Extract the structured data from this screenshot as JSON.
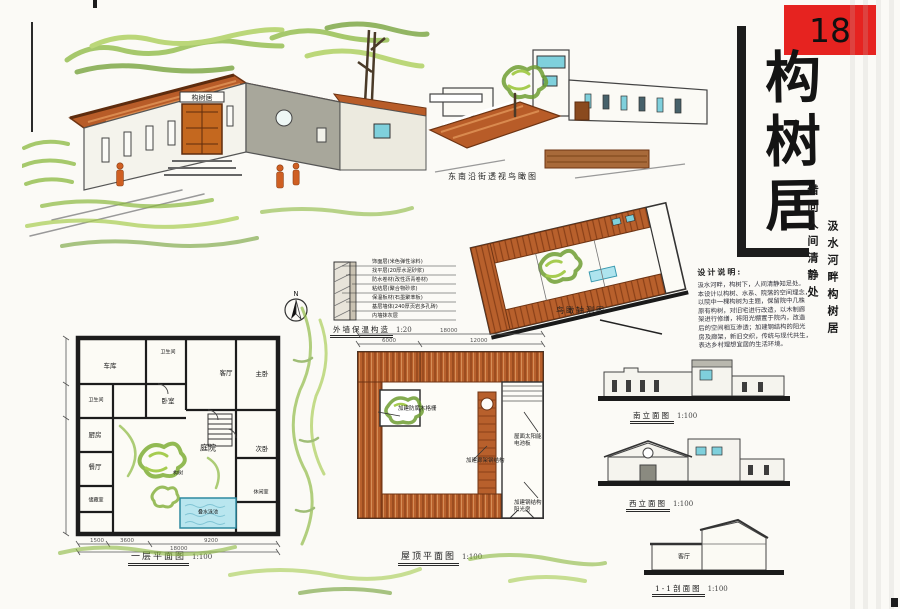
{
  "sheet": {
    "number": "18"
  },
  "title": {
    "main": "构树居",
    "chars": [
      "构",
      "树",
      "居"
    ],
    "subtitle_right_inner": "借问人间清静处",
    "subtitle_right_outer": "汲水河畔构树居"
  },
  "design_notes": {
    "heading": "设计说明:",
    "lines": [
      "汲水河畔，构树下，人间清静知足处。",
      "本设计以构树、水系、院落的空间理念，",
      "以院中一棵构树为主题，保留院中几株",
      "原有构树，对旧宅进行改造，以木制廊",
      "架进行修缮，将阳光棚置于院内，改造",
      "后的空间相互渗透；加建钢结构的阳光",
      "房及廊架，新旧交织，传统与现代共生，",
      "表达乡村理想宜居的生活环境。"
    ]
  },
  "perspectives": {
    "street_caption": "东南沿街透视鸟瞰图",
    "birdseye_caption": "鸟瞰轴测图",
    "door_plaque": "构树居"
  },
  "floor_plan": {
    "caption": "一层平面图",
    "scale": "1:100",
    "north": "N",
    "rooms": [
      {
        "label": "车库"
      },
      {
        "label": "卫生间"
      },
      {
        "label": "客厅"
      },
      {
        "label": "主卧"
      },
      {
        "label": "卧室"
      },
      {
        "label": "卫生间"
      },
      {
        "label": "厨房"
      },
      {
        "label": "餐厅"
      },
      {
        "label": "储藏室"
      },
      {
        "label": "庭院"
      },
      {
        "label": "构树"
      },
      {
        "label": "叠水泳池"
      },
      {
        "label": "次卧"
      },
      {
        "label": "休闲室"
      }
    ],
    "dims": {
      "segments": [
        "1500",
        "3600",
        "9200"
      ],
      "total": "18000"
    }
  },
  "roof_plan": {
    "caption": "屋顶平面图",
    "scale": "1:100",
    "annotations": [
      {
        "label": "加建防腐木格栅"
      },
      {
        "label": "加建廊架钢结构"
      },
      {
        "label": "屋面太阳能电池板"
      },
      {
        "label": "加建钢结构阳光房"
      }
    ],
    "dims": {
      "segments": [
        "6000",
        "12000"
      ],
      "total": "18000"
    }
  },
  "wall_detail": {
    "caption": "外墙保温构造",
    "scale": "1:20",
    "layers": [
      {
        "label": "饰面层(米色弹性涂料)"
      },
      {
        "label": "找平层(20厚水泥砂浆)"
      },
      {
        "label": "防水卷材(改性沥青卷材)"
      },
      {
        "label": "粘结层(聚合物砂浆)"
      },
      {
        "label": "保温板材(石墨聚苯板)"
      },
      {
        "label": "基层墙体(240厚页岩多孔砖)"
      },
      {
        "label": "内墙抹灰层"
      }
    ]
  },
  "elevations": {
    "south": {
      "caption": "南立面图",
      "scale": "1:100"
    },
    "west": {
      "caption": "西立面图",
      "scale": "1:100"
    },
    "section": {
      "caption": "1-1剖面图",
      "scale": "1:100",
      "room_label": "客厅"
    }
  },
  "colors": {
    "accent_red": "#e62320",
    "roof_orange": "#b85c28",
    "foliage_green": "#8ab83e",
    "water_cyan": "#7fd0dc",
    "wall_gray": "#a8a79b",
    "ink": "#2a2a2a"
  }
}
